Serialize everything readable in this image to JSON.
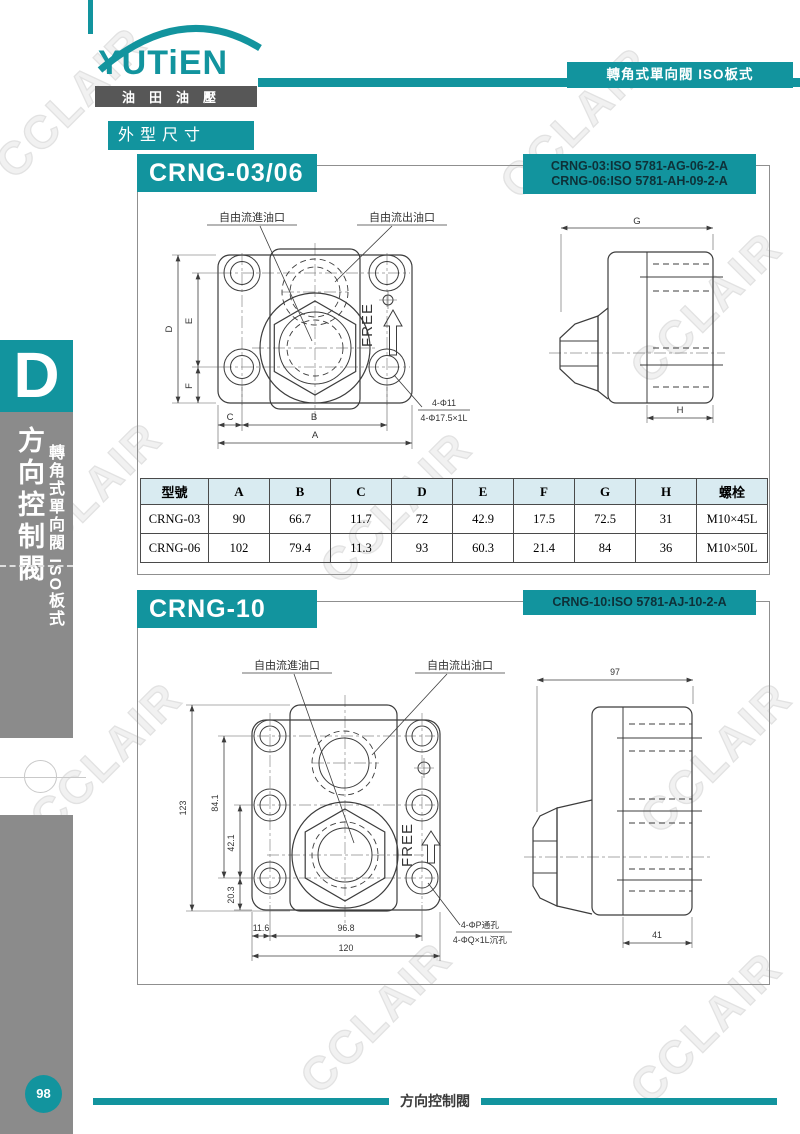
{
  "brand": {
    "name": "YUTiEN",
    "sub": "油田油壓"
  },
  "header": {
    "tag": "轉角式單向閥 ISO板式"
  },
  "page_label": "外型尺寸",
  "watermark": "CCLAIR",
  "sidebar": {
    "letter": "D",
    "title": "方向控制閥",
    "subtitle": "轉角式單向閥 ISO板式"
  },
  "footer": {
    "page": "98",
    "label": "方向控制閥"
  },
  "colors": {
    "teal": "#12949e",
    "sidebar_gray": "#8b8b8b",
    "table_header_bg": "#d9ebf1",
    "iso_text": "#0e3138"
  },
  "section1": {
    "title": "CRNG-03/06",
    "iso1": "CRNG-03:ISO 5781-AG-06-2-A",
    "iso2": "CRNG-06:ISO 5781-AH-09-2-A",
    "front": {
      "inlet_label": "自由流進油口",
      "outlet_label": "自由流出油口",
      "free": "FREE",
      "dim_a": "A",
      "dim_b": "B",
      "dim_c": "C",
      "dim_d": "D",
      "dim_e": "E",
      "dim_f": "F",
      "note1": "4-Φ11",
      "note2": "4-Φ17.5×1L"
    },
    "side": {
      "dim_g": "G",
      "dim_h": "H"
    }
  },
  "table": {
    "headers": [
      "型號",
      "A",
      "B",
      "C",
      "D",
      "E",
      "F",
      "G",
      "H",
      "螺栓"
    ],
    "rows": [
      [
        "CRNG-03",
        "90",
        "66.7",
        "11.7",
        "72",
        "42.9",
        "17.5",
        "72.5",
        "31",
        "M10×45L"
      ],
      [
        "CRNG-06",
        "102",
        "79.4",
        "11.3",
        "93",
        "60.3",
        "21.4",
        "84",
        "36",
        "M10×50L"
      ]
    ]
  },
  "section2": {
    "title": "CRNG-10",
    "iso1": "CRNG-10:ISO 5781-AJ-10-2-A",
    "front": {
      "inlet_label": "自由流進油口",
      "outlet_label": "自由流出油口",
      "free": "FREE",
      "dim_height_total": "123",
      "dim_holes_v": "84.1",
      "dim_mid_v": "42.1",
      "dim_bottom_v": "20.3",
      "dim_left_w": "11.6",
      "dim_holes_w": "96.8",
      "dim_width_total": "120",
      "note1": "4-ΦP通孔",
      "note2": "4-ΦQ×1L沉孔"
    },
    "side": {
      "dim_width": "97",
      "dim_port": "41"
    }
  }
}
